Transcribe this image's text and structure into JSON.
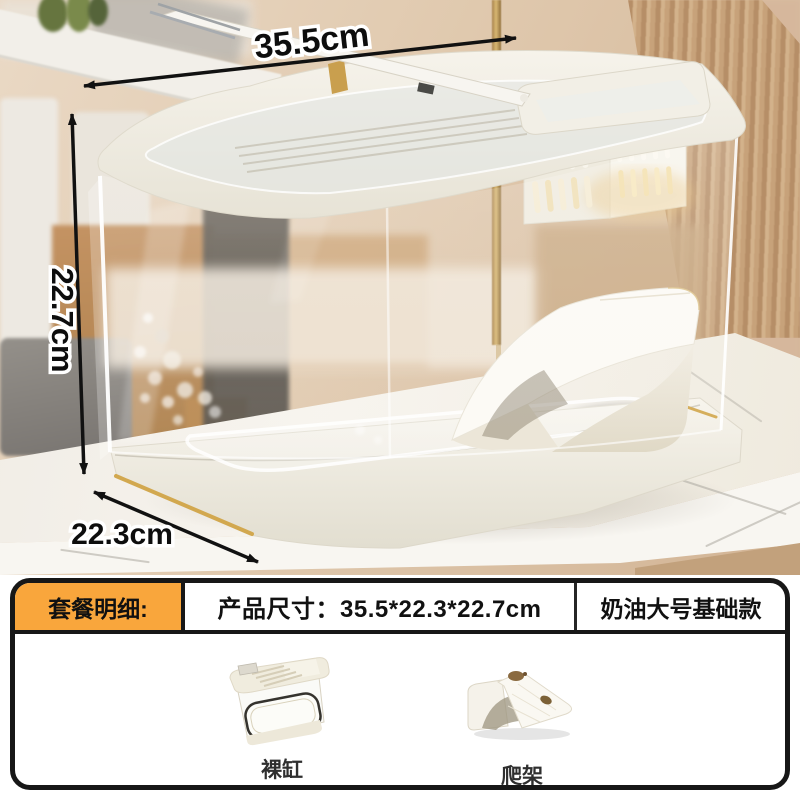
{
  "product_photo": {
    "dimension_labels": {
      "width": "35.5cm",
      "height": "22.7cm",
      "depth": "22.3cm"
    }
  },
  "info_panel": {
    "badge_label": "套餐明细:",
    "product_size_label": "产品尺寸：35.5*22.3*22.7cm",
    "variant_label": "奶油大号基础款",
    "included_items": [
      {
        "caption": "裸缸"
      },
      {
        "caption": "爬架"
      }
    ],
    "colors": {
      "badge_background": "#F9A63C",
      "panel_border": "#171717",
      "caption_text": "#2F2F2F",
      "accent_gold": "#D2A84F"
    }
  }
}
